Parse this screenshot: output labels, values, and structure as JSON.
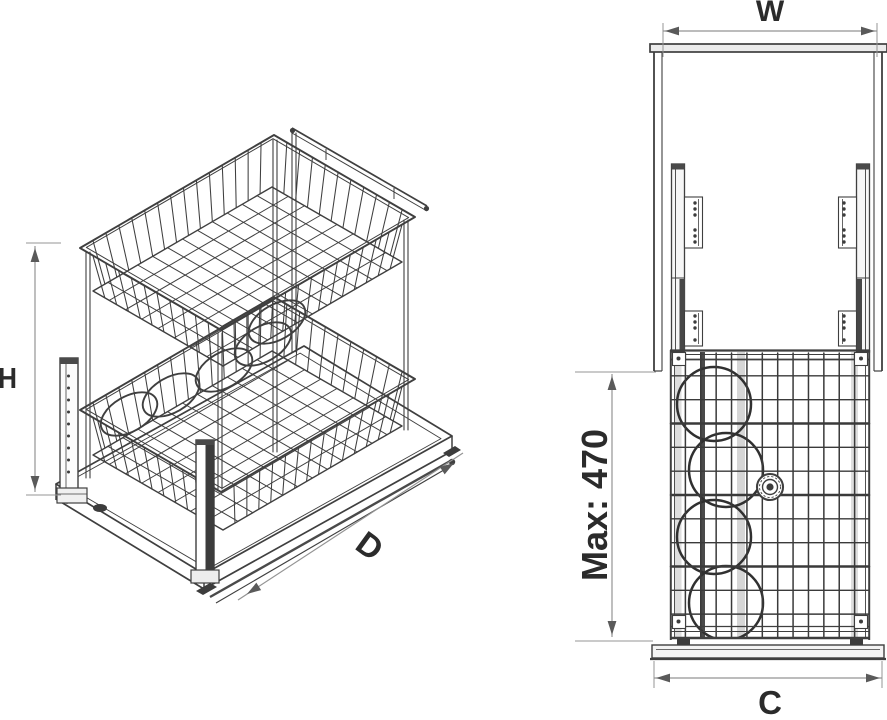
{
  "diagram": {
    "labels": {
      "height": "H",
      "depth": "D",
      "width": "W",
      "max_pullout": "Max: 470",
      "carcass": "C"
    },
    "colors": {
      "line": "#3f3f3f",
      "dimension_line": "#949494",
      "dimension_arrow": "#5a5a5a",
      "text": "#2b2b2b",
      "background": "#ffffff",
      "light_fill": "#e0e0e0",
      "dark_fill": "#3c3c3c"
    }
  }
}
